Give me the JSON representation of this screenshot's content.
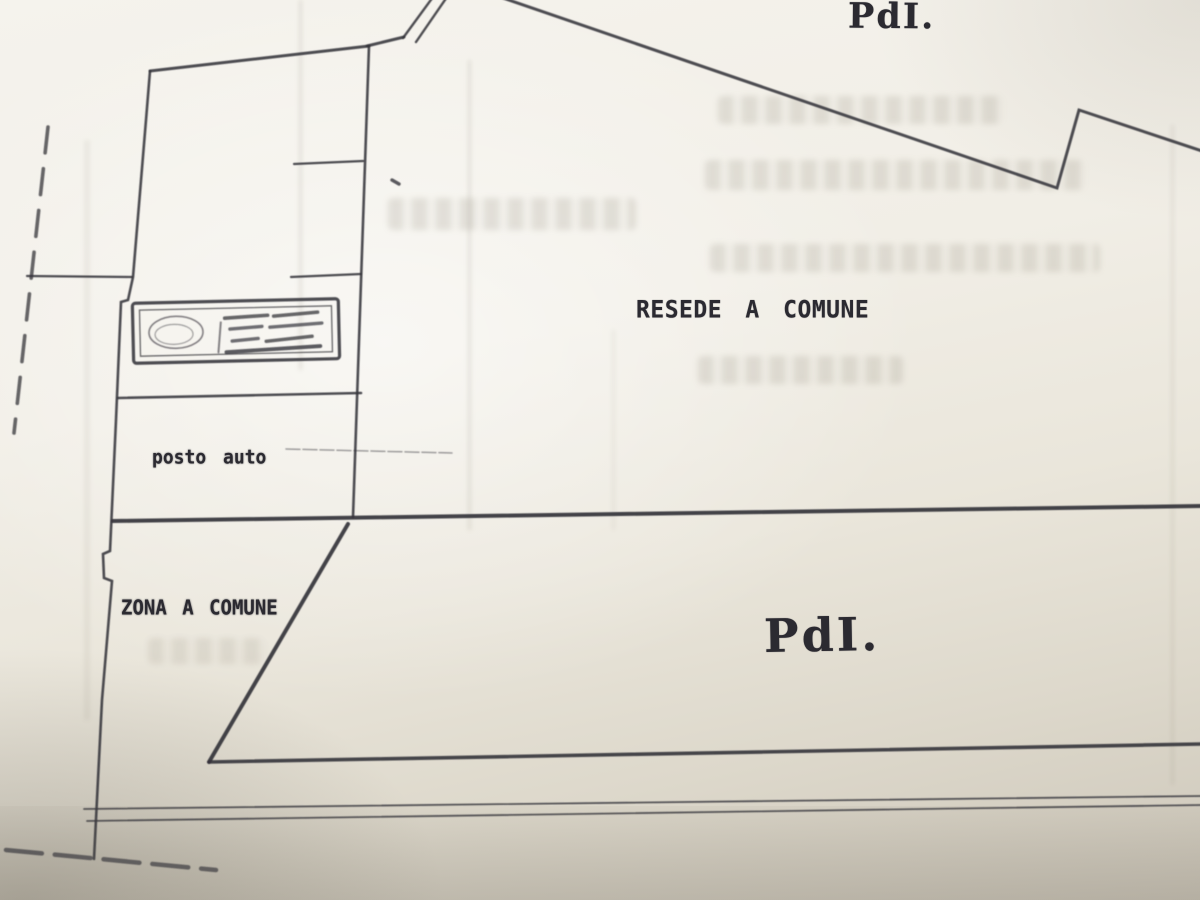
{
  "plan": {
    "labels": {
      "top_parcel": "PdI.",
      "common_yard": "RESEDE A COMUNE",
      "parking": "posto auto",
      "common_zone": "ZONA A COMUNE",
      "lower_parcel": "PdI."
    },
    "colors": {
      "ink": "#35343b",
      "paper": "#efece4"
    }
  }
}
